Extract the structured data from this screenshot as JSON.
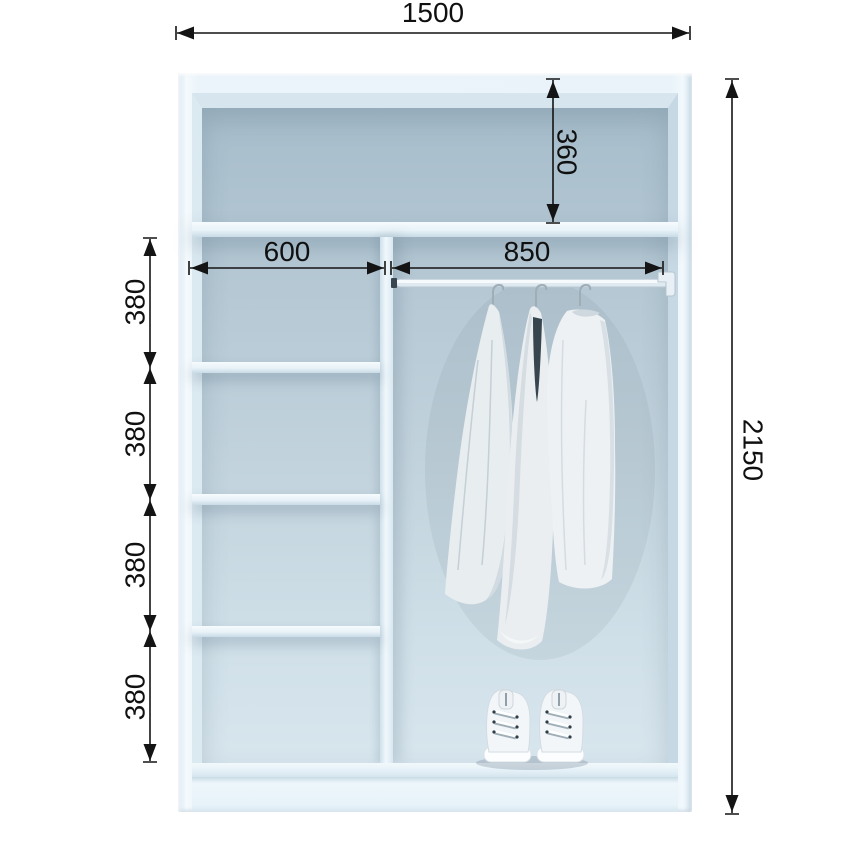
{
  "diagram": {
    "subject": "wardrobe interior front-view dimension drawing",
    "unit": "mm",
    "dims": {
      "overall_width": "1500",
      "overall_height": "2150",
      "top_shelf_drop": "360",
      "shelf_column_width": "600",
      "hanging_rail_width": "850",
      "shelf_gaps": [
        "380",
        "380",
        "380",
        "380"
      ]
    },
    "contents": {
      "hanging_garments_count": 3,
      "shoe_pairs_count": 1,
      "shelf_count_left_column": 3
    },
    "colors": {
      "dimension_ink": "#141414",
      "cabinet_frame": "#e9f3f9",
      "interior_wall_top": "#a7bdcb",
      "interior_wall_bottom": "#d8e6ee",
      "background": "#ffffff"
    }
  }
}
